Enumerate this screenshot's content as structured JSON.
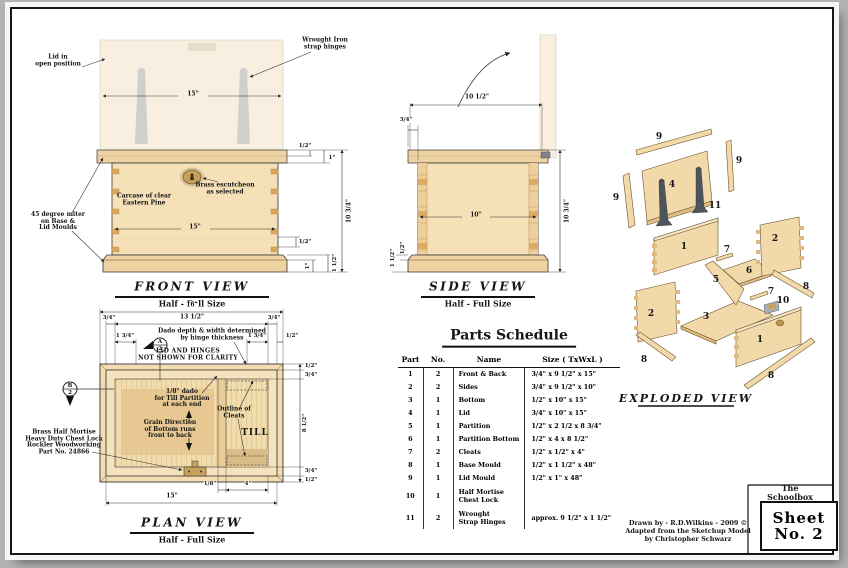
{
  "front_view": {
    "title": "FRONT VIEW",
    "subtitle": "Half - Full Size",
    "labels": {
      "lid_open": "Lid in\nopen position",
      "hinges": "Wrought Iron\nstrap hinges",
      "escutcheon": "Brass escutcheon\nas selected",
      "carcase": "Carcase of clear\nEastern Pine",
      "miter": "45 degree miter\non  Base &\nLid Moulds"
    },
    "dims": {
      "lid_width": "15\"",
      "carcase_width": "15\"",
      "overall_height": "10 3/4\"",
      "lid_mould": "1/2\"",
      "lid_thickness": "1\"",
      "pin": "1/2\"",
      "base_board": "1\"",
      "base_mould": "1 1/2\""
    }
  },
  "side_view": {
    "title": "SIDE VIEW",
    "subtitle": "Half - Full Size",
    "dims": {
      "overall_depth": "10 1/2\"",
      "lid_overhang": "3/4\"",
      "carcase_depth": "10\"",
      "overall_height": "10 3/4\"",
      "mould_proj": "1/2\"",
      "base_mould": "1 1/2\""
    }
  },
  "plan_view": {
    "title": "PLAN VIEW",
    "subtitle": "Half - Full Size",
    "labels": {
      "dado_note": "Dado depth & width determined\nby hinge thickness",
      "clarity_note": "LID AND HINGES\nNOT SHOWN FOR CLARITY",
      "till_dado": "1/8\" dado\nfor Till Partition\nat each end",
      "grain": "Grain Direction\nof Bottom runs\nfront to back",
      "cleats": "Outline of\nCleats",
      "till": "TILL",
      "lock": "Brass Half Mortise\nHeavy Duty Chest Lock\nRockler Woodworking\nPart No. 24866"
    },
    "sections": {
      "a_letter": "A",
      "a_num": "2",
      "b_letter": "B",
      "b_num": "2"
    },
    "dims": {
      "overall_width": "16\"",
      "inner_width": "13 1/2\"",
      "wall_left": "3/4\"",
      "wall_right": "3/4\"",
      "hinge_left": "1 3/4\"",
      "hinge_right": "1 3/4\"",
      "mould_right": "1/2\"",
      "r_mould": "1/2\"",
      "r_wall_top": "3/4\"",
      "r_interior": "8 1/2\"",
      "r_wall_bottom": "3/4\"",
      "r_mould_b": "1/2\"",
      "till_dado_w": "1/8\"",
      "till_width": "4\"",
      "bottom_width": "15\""
    }
  },
  "parts_schedule": {
    "title": "Parts Schedule",
    "headers": [
      "Part",
      "No.",
      "Name",
      "Size  ( TxWxL )"
    ],
    "rows": [
      [
        "1",
        "2",
        "Front & Back",
        "3/4\"  x  9 1/2\"  x  15\""
      ],
      [
        "2",
        "2",
        "Sides",
        "3/4\"  x  9 1/2\"  x  10\""
      ],
      [
        "3",
        "1",
        "Bottom",
        "1/2\"  x  10\"  x  15\""
      ],
      [
        "4",
        "1",
        "Lid",
        "3/4\"  x  10\"  x  15\""
      ],
      [
        "5",
        "1",
        "Partition",
        "1/2\"  x  2 1/2 x 8 3/4\""
      ],
      [
        "6",
        "1",
        "Partition Bottom",
        "1/2\"  x  4   x 8 1/2\""
      ],
      [
        "7",
        "2",
        "Cleats",
        "1/2\"  x  1/2\"  x  4\""
      ],
      [
        "8",
        "1",
        "Base Mould",
        "1/2\"  x  1 1/2\"  x  48\""
      ],
      [
        "9",
        "1",
        "Lid Mould",
        "1/2\"  x  1\"  x  48\""
      ],
      [
        "10",
        "1",
        "Half Mortise\nChest Lock",
        ""
      ],
      [
        "11",
        "2",
        "Wrought\nStrap Hinges",
        "approx. 9 1/2\" x 1 1/2\""
      ]
    ]
  },
  "exploded_view": {
    "title": "EXPLODED VIEW",
    "part_labels": [
      {
        "n": "9",
        "x": 51,
        "y": 29
      },
      {
        "n": "9",
        "x": 131,
        "y": 53
      },
      {
        "n": "9",
        "x": 8,
        "y": 90
      },
      {
        "n": "4",
        "x": 64,
        "y": 77
      },
      {
        "n": "11",
        "x": 107,
        "y": 98
      },
      {
        "n": "1",
        "x": 76,
        "y": 139
      },
      {
        "n": "7",
        "x": 119,
        "y": 142
      },
      {
        "n": "6",
        "x": 141,
        "y": 163
      },
      {
        "n": "2",
        "x": 167,
        "y": 131
      },
      {
        "n": "8",
        "x": 198,
        "y": 179
      },
      {
        "n": "2",
        "x": 43,
        "y": 206
      },
      {
        "n": "8",
        "x": 36,
        "y": 252
      },
      {
        "n": "3",
        "x": 98,
        "y": 209
      },
      {
        "n": "5",
        "x": 108,
        "y": 172
      },
      {
        "n": "7",
        "x": 163,
        "y": 184
      },
      {
        "n": "10",
        "x": 175,
        "y": 193
      },
      {
        "n": "1",
        "x": 152,
        "y": 232
      },
      {
        "n": "8",
        "x": 163,
        "y": 268
      }
    ]
  },
  "title_block": {
    "project": "The Schoolbox",
    "sheet_word": "Sheet",
    "sheet_number": "No. 2",
    "credits": "Drawn by  -  R.D.Wilkins  -  2009 ©\nAdapted from the Sketchup Model\nby Christopher Schwarz"
  }
}
